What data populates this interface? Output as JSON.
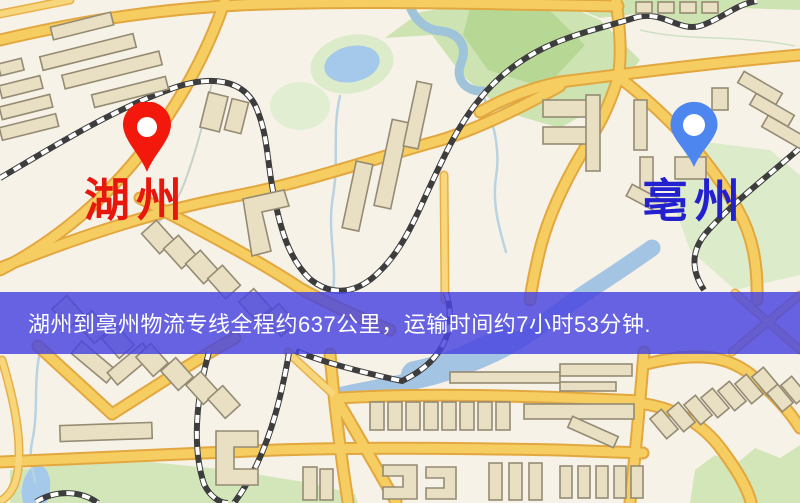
{
  "map": {
    "origin": {
      "name": "湖州",
      "label_color": "#e8170d",
      "pin_color": "#f2190c"
    },
    "destination": {
      "name": "亳州",
      "label_color": "#2321cf",
      "pin_color": "#4d86ef"
    }
  },
  "banner": {
    "text": "湖州到亳州物流专线全程约637公里，运输时间约7小时53分钟.",
    "route_name": "湖州到亳州物流专线",
    "distance_km": 637,
    "duration": "7小时53分钟",
    "background_color": "#4844e0",
    "text_color": "#ffffff"
  },
  "palette": {
    "map_background": "#f7f2e8",
    "road_fill": "#f6cd61",
    "road_casing": "#e2a83f",
    "building_fill": "#e9e0c4",
    "building_stroke": "#958b74",
    "park_green": "#cde4b2",
    "water_blue": "#a5c9ea",
    "railway_dark": "#3d3d3d"
  }
}
